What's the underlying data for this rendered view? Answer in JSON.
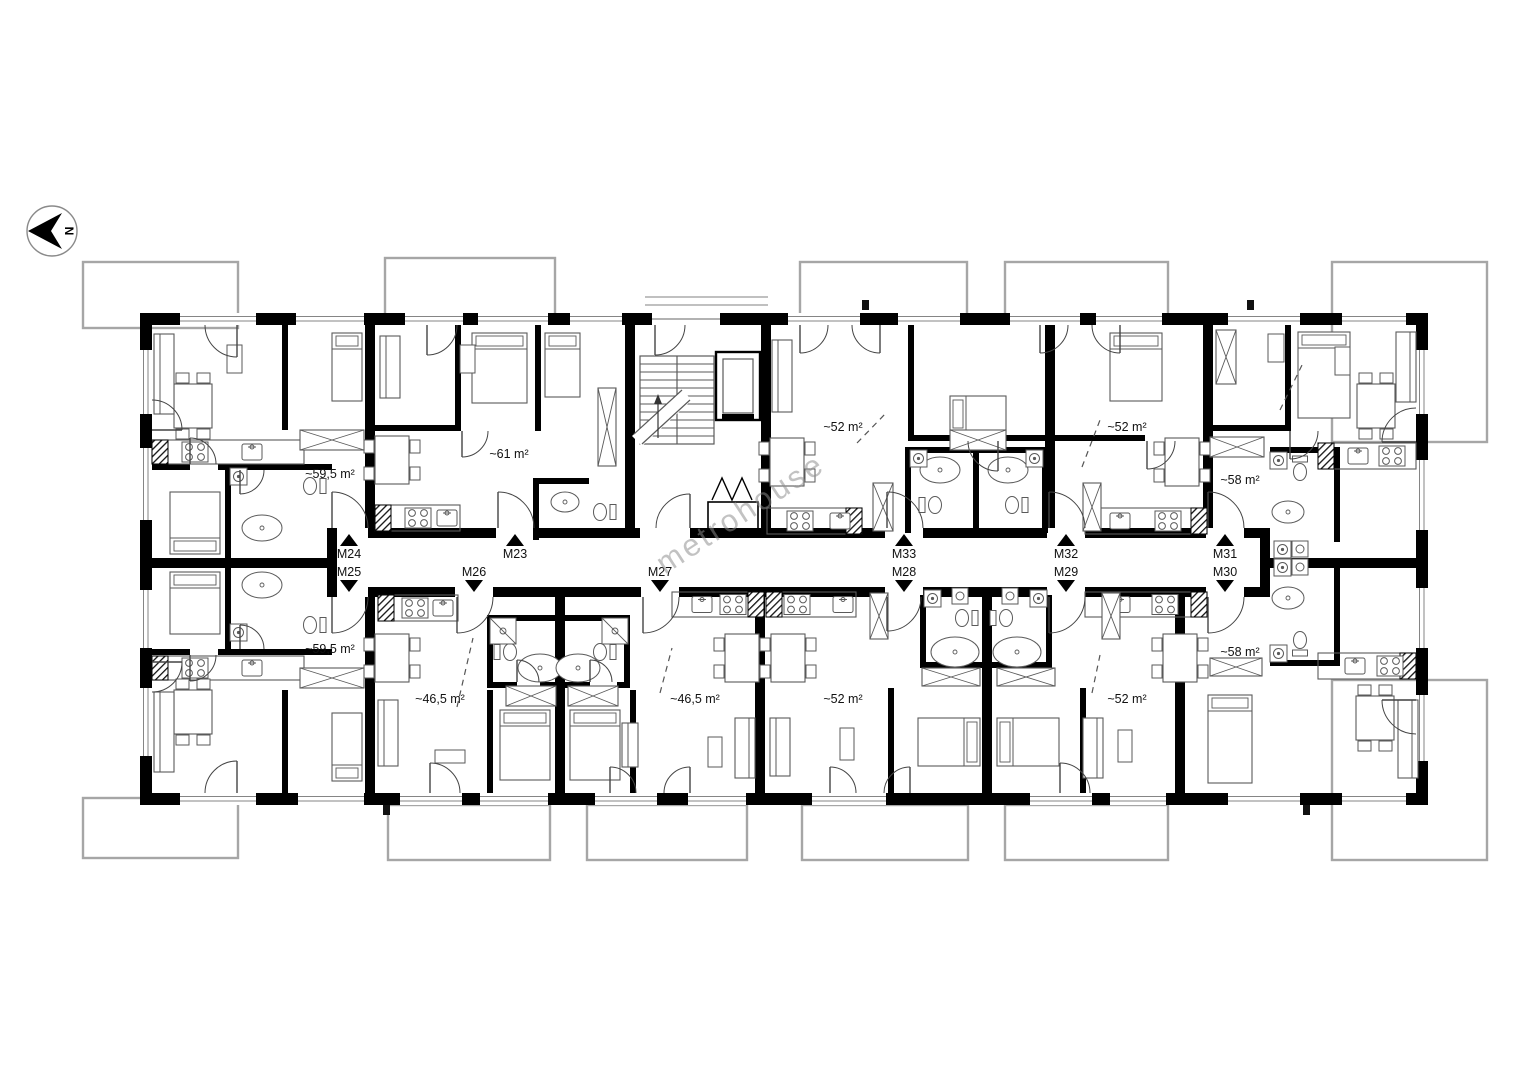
{
  "north_indicator": {
    "label": "N"
  },
  "watermark": {
    "text": "metrohouse"
  },
  "corridor_labels": [
    {
      "text": "M24",
      "direction": "up"
    },
    {
      "text": "M25",
      "direction": "down"
    },
    {
      "text": "M23",
      "direction": "up"
    },
    {
      "text": "M26",
      "direction": "down"
    },
    {
      "text": "M27",
      "direction": "down"
    },
    {
      "text": "M33",
      "direction": "up"
    },
    {
      "text": "M28",
      "direction": "down"
    },
    {
      "text": "M32",
      "direction": "up"
    },
    {
      "text": "M29",
      "direction": "down"
    },
    {
      "text": "M31",
      "direction": "up"
    },
    {
      "text": "M30",
      "direction": "down"
    }
  ],
  "area_labels": [
    {
      "text": "~59,5 m²",
      "unit": "M24"
    },
    {
      "text": "~61 m²",
      "unit": "M23"
    },
    {
      "text": "~52 m²",
      "unit": "M33"
    },
    {
      "text": "~52 m²",
      "unit": "M32"
    },
    {
      "text": "~58 m²",
      "unit": "M31"
    },
    {
      "text": "~59,5 m²",
      "unit": "M25"
    },
    {
      "text": "~46,5 m²",
      "unit": "M26"
    },
    {
      "text": "~46,5 m²",
      "unit": "M27"
    },
    {
      "text": "~52 m²",
      "unit": "M28"
    },
    {
      "text": "~52 m²",
      "unit": "M29"
    },
    {
      "text": "~58 m²",
      "unit": "M30"
    }
  ],
  "colors": {
    "wall": "#000000",
    "furniture": "#5a5a5a",
    "balcony_outline": "#a6a6a6",
    "window_line": "#858585",
    "watermark": "#8c8c8c",
    "label_text": "#111111"
  }
}
